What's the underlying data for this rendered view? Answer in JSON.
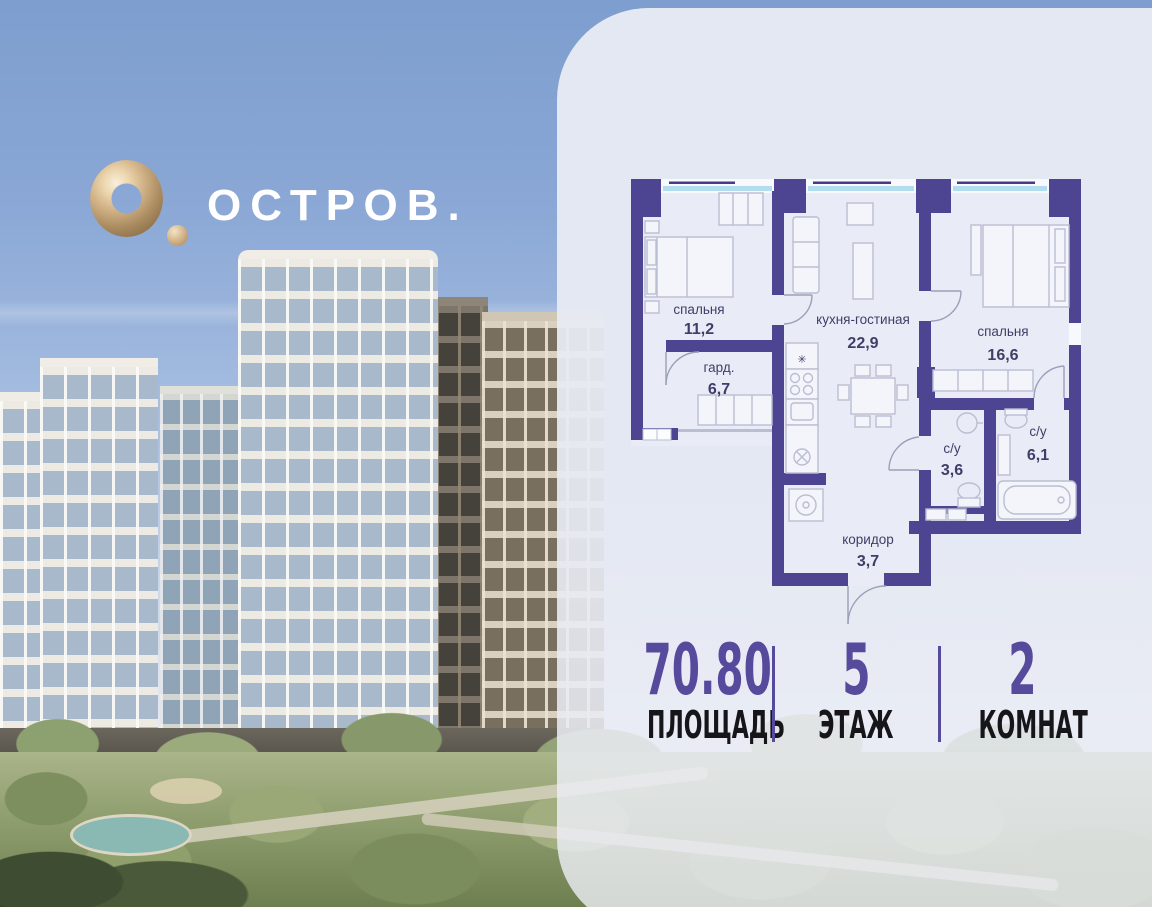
{
  "brand": {
    "wordmark": "ОСТРОВ."
  },
  "floor_plan": {
    "rooms": [
      {
        "name": "спальня",
        "area": "11,2"
      },
      {
        "name": "кухня-гостиная",
        "area": "22,9"
      },
      {
        "name": "спальня",
        "area": "16,6"
      },
      {
        "name": "гард.",
        "area": "6,7"
      },
      {
        "name": "с/у",
        "area": "3,6"
      },
      {
        "name": "с/у",
        "area": "6,1"
      },
      {
        "name": "коридор",
        "area": "3,7"
      }
    ],
    "symbols": {
      "vent": "✳"
    }
  },
  "stats": {
    "items": [
      {
        "value": "70.80",
        "label": "ПЛОЩАДЬ"
      },
      {
        "value": "5",
        "label": "ЭТАЖ"
      },
      {
        "value": "2",
        "label": "КОМНАТ"
      }
    ]
  },
  "colors": {
    "wall": "#4e4592",
    "accent": "#564a9c",
    "gold": "#c9a97c",
    "window_glass": "#b2ddef",
    "sky": "#8aa7d5"
  }
}
